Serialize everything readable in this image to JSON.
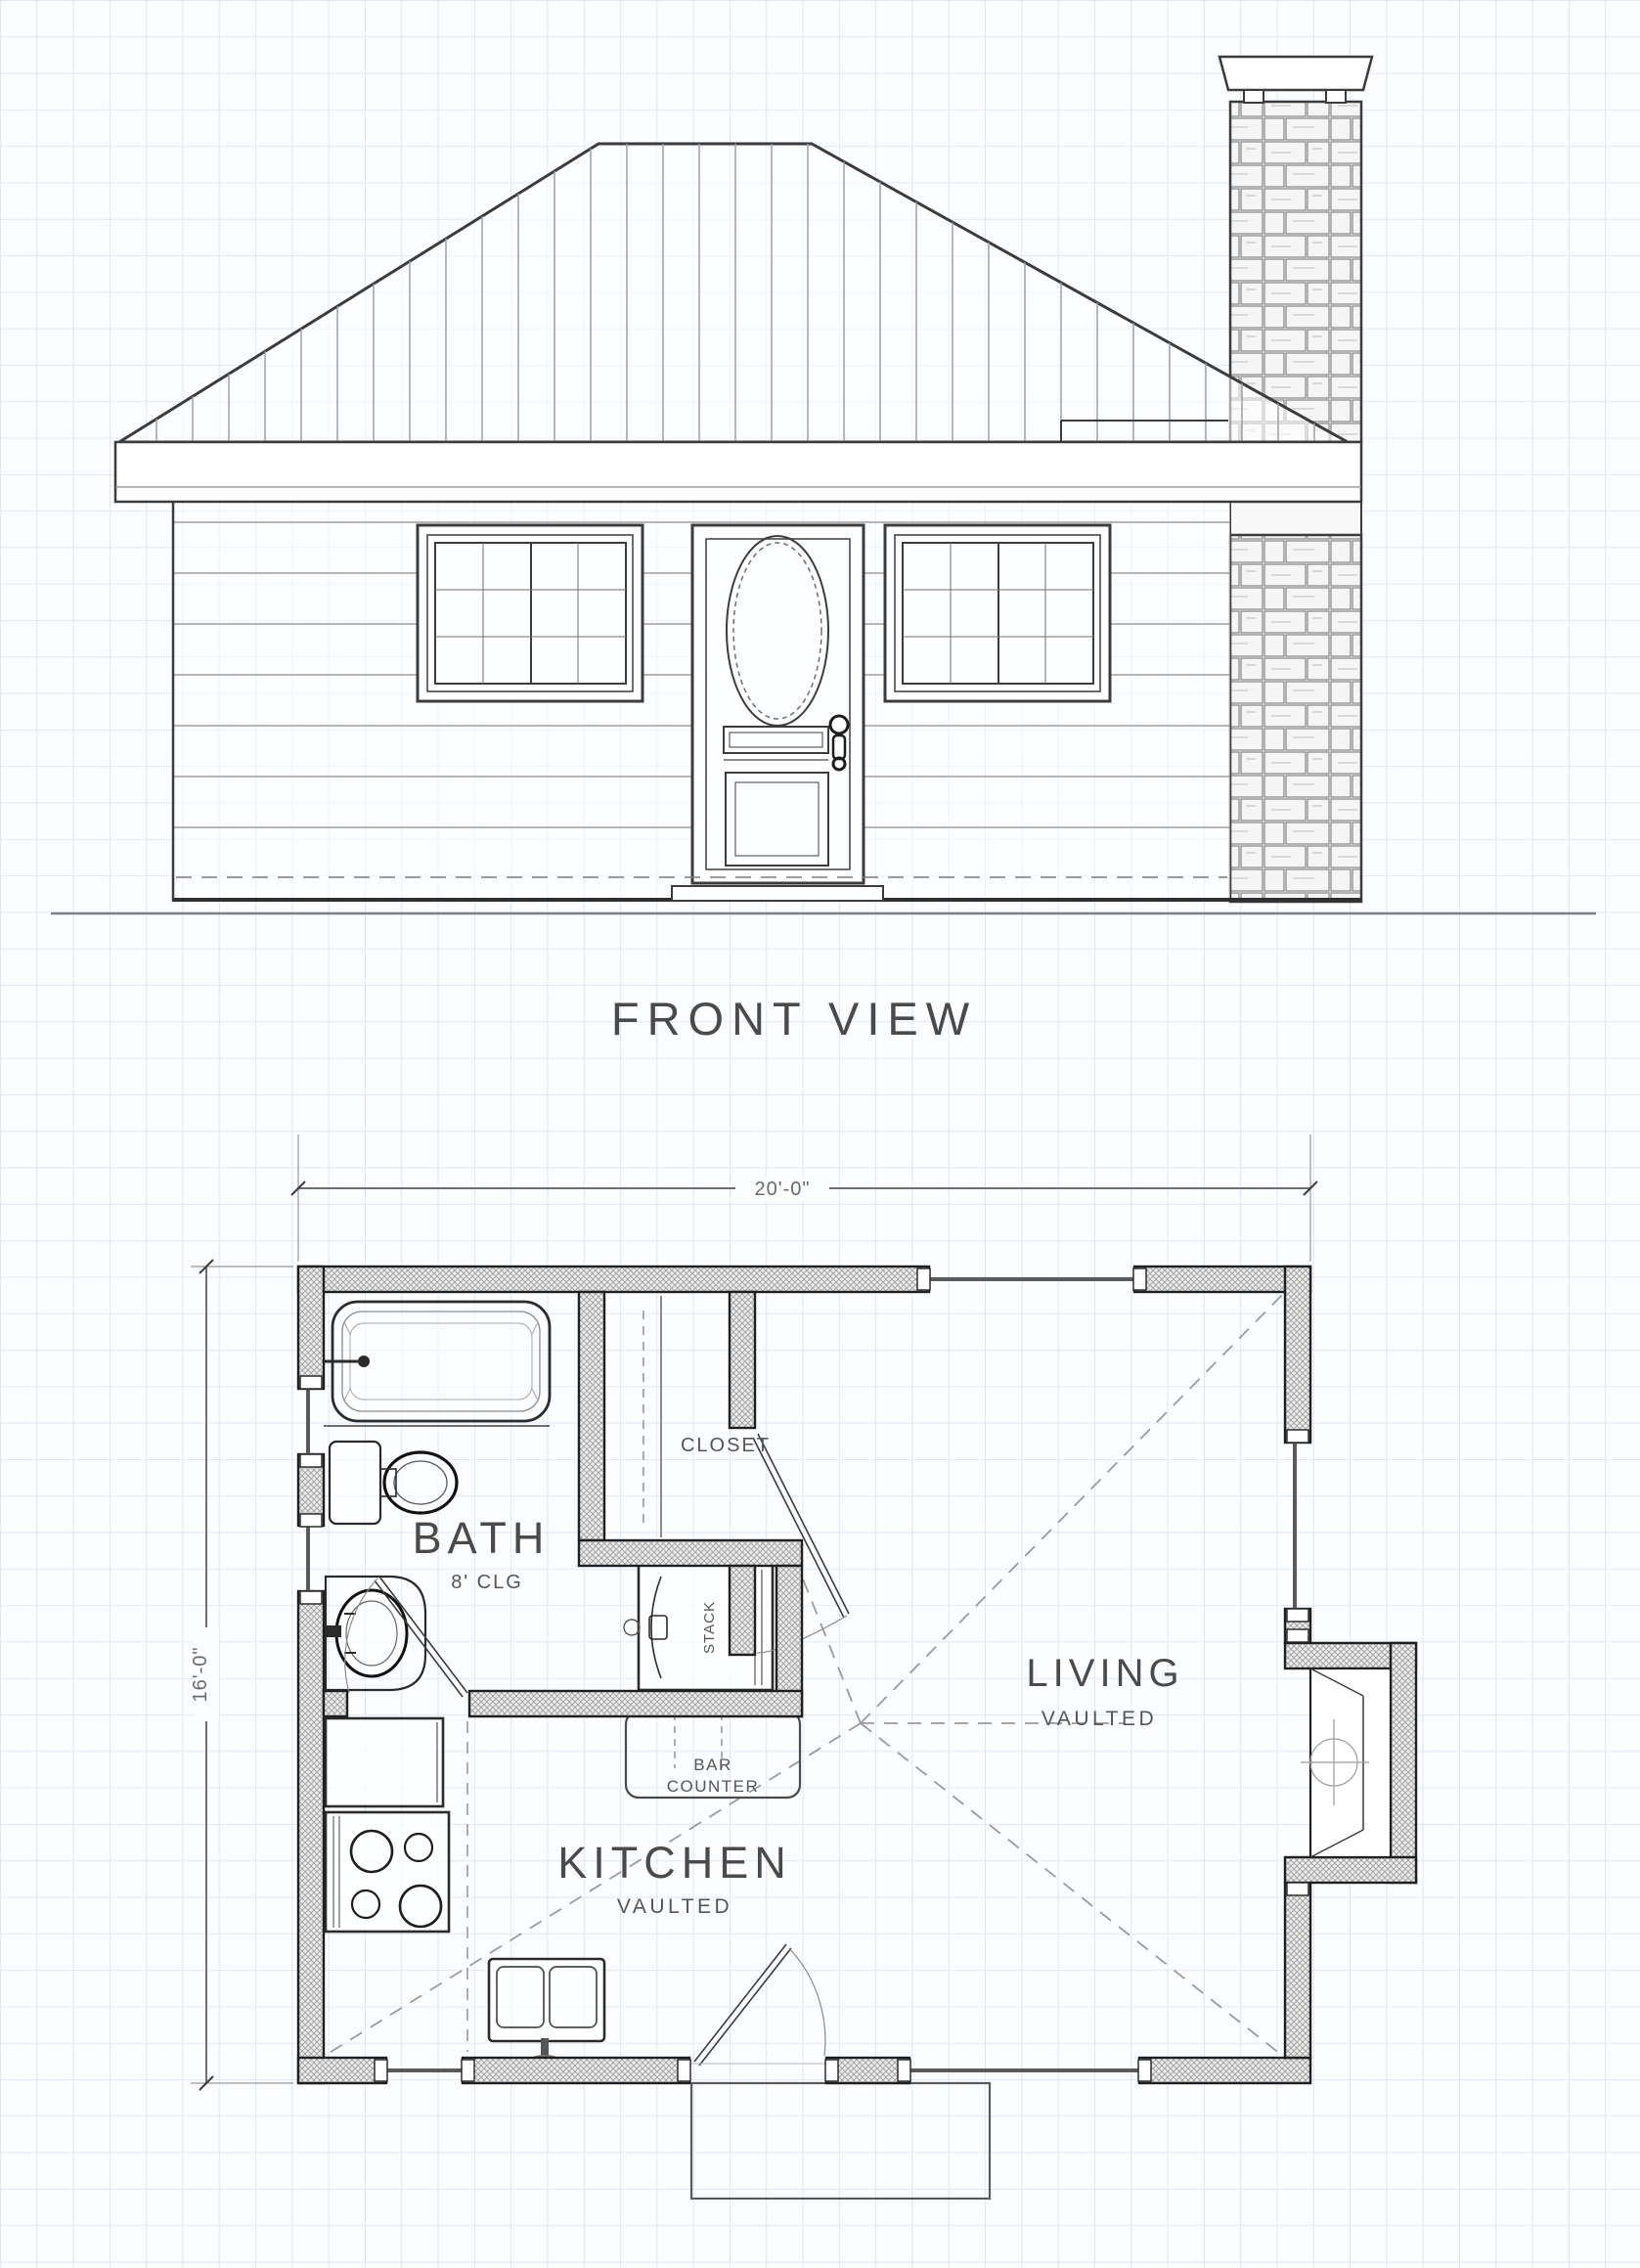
{
  "elevation": {
    "title": "FRONT VIEW"
  },
  "plan": {
    "dim_width": "20'-0\"",
    "dim_height": "16'-0\"",
    "rooms": {
      "bath": {
        "name": "BATH",
        "note": "8' CLG"
      },
      "closet": {
        "name": "CLOSET"
      },
      "living": {
        "name": "LIVING",
        "note": "VAULTED"
      },
      "kitchen": {
        "name": "KITCHEN",
        "note": "VAULTED"
      }
    },
    "labels": {
      "stack_wd_line1": "STACK",
      "stack_wd_line2": "W/D",
      "bar_line1": "BAR",
      "bar_line2": "COUNTER"
    }
  },
  "colors": {
    "paper": "#fbfdff",
    "grid": "#d6e2f0",
    "ink": "#3c3c3c",
    "wall_fill": "#ececec",
    "dim": "#6f6f6f"
  }
}
